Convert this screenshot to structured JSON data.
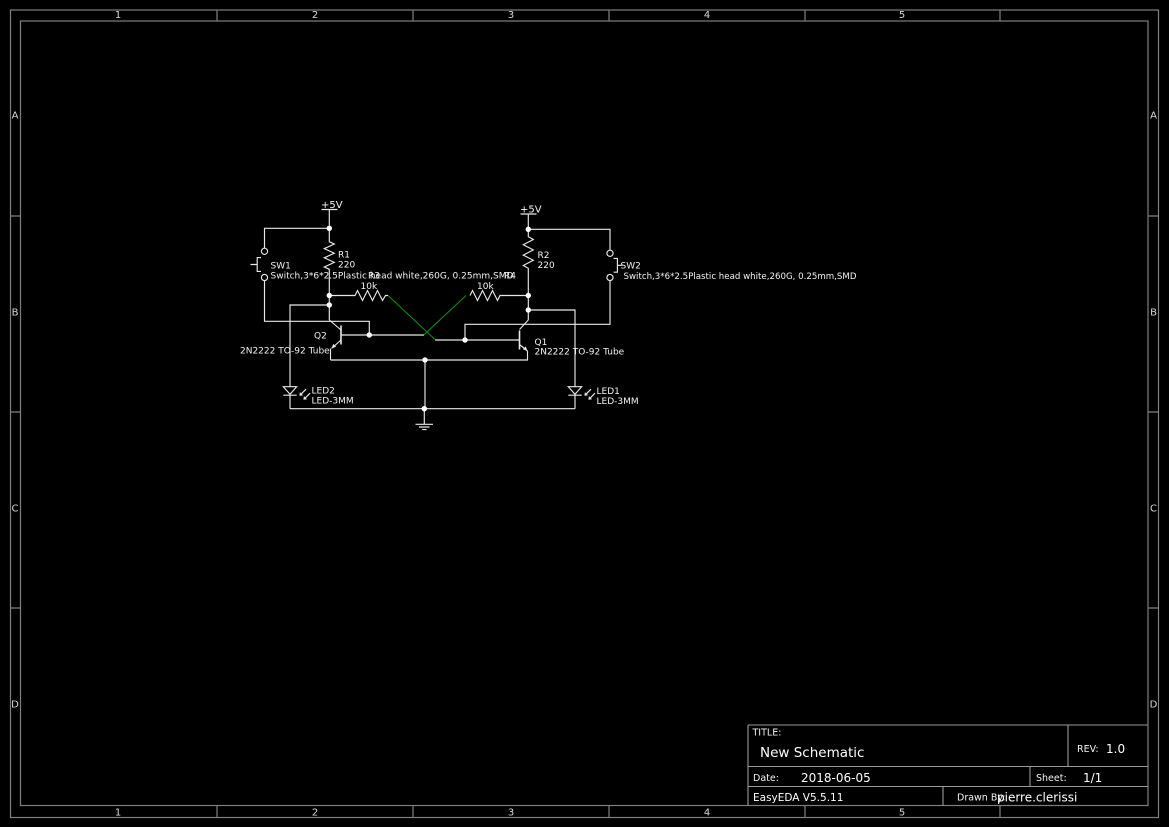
{
  "frame": {
    "column_labels": [
      "1",
      "2",
      "3",
      "4",
      "5"
    ],
    "row_labels": [
      "A",
      "B",
      "C",
      "D"
    ]
  },
  "title_block": {
    "title_label": "TITLE:",
    "title": "New Schematic",
    "rev_label": "REV:",
    "rev": "1.0",
    "date_label": "Date:",
    "date": "2018-06-05",
    "sheet_label": "Sheet:",
    "sheet": "1/1",
    "tool_version": "EasyEDA V5.5.11",
    "drawn_by_label": "Drawn By:",
    "drawn_by": "pierre.clerissi"
  },
  "schematic": {
    "power": {
      "left": "+5V",
      "right": "+5V"
    },
    "components": {
      "R1": {
        "name": "R1",
        "value": "220"
      },
      "R2": {
        "name": "R2",
        "value": "220"
      },
      "R3": {
        "name": "R3",
        "value": "10k"
      },
      "R4": {
        "name": "R4",
        "value": "10k"
      },
      "SW1": {
        "name": "SW1",
        "value": "Switch,3*6*2.5Plastic head white,260G, 0.25mm,SMD"
      },
      "SW2": {
        "name": "SW2",
        "value": "Switch,3*6*2.5Plastic head white,260G, 0.25mm,SMD"
      },
      "Q1": {
        "name": "Q1",
        "value": "2N2222 TO-92 Tube"
      },
      "Q2": {
        "name": "Q2",
        "value": "2N2222 TO-92 Tube"
      },
      "LED1": {
        "name": "LED1",
        "value": "LED-3MM"
      },
      "LED2": {
        "name": "LED2",
        "value": "LED-3MM"
      }
    }
  },
  "colors": {
    "background": "#000000",
    "frame": "#7f7f7f",
    "wire": "#e8e8e8",
    "cross_coupling_wire": "#0f8a0f",
    "text": "#f2f2f2"
  }
}
